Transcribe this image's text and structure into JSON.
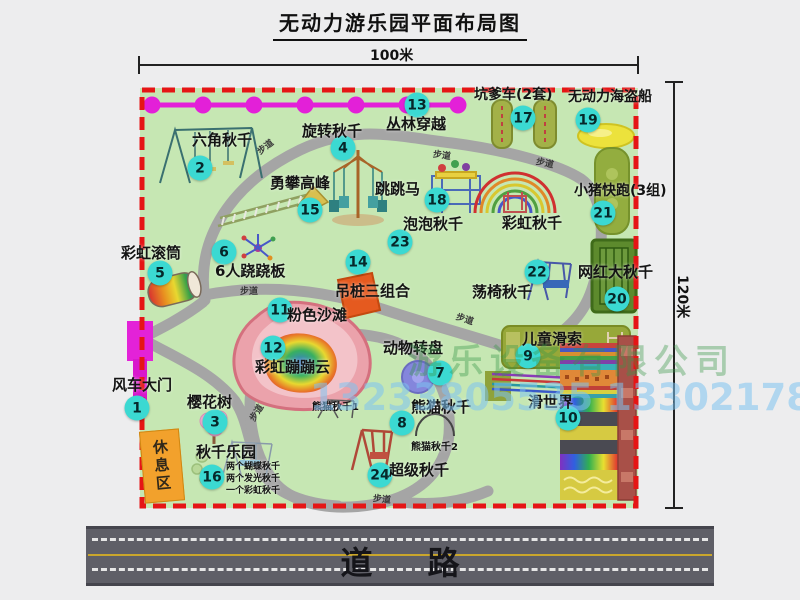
{
  "title": "无动力游乐园平面布局图",
  "dim": {
    "w": "100米",
    "h": "120米"
  },
  "road_label": "道路",
  "watermark": {
    "company": "游乐设备有限公司",
    "phone": "13233805535 13302178333"
  },
  "rest_area_label": "休息区",
  "colors": {
    "badge": "#3bd9d2",
    "border_dashed": "#e51515",
    "map_bg": "#c6e7b3",
    "walkway": "#a5a5a5",
    "chain": "#e320d8",
    "road": "#5f5f67",
    "rest_area": "#f2a12c"
  },
  "legend_items": [
    {
      "n": "1",
      "t": "风车大门",
      "bx": -3,
      "by": 320,
      "lx": -28,
      "ly": 290,
      "s": 15
    },
    {
      "n": "2",
      "t": "六角秋千",
      "bx": 60,
      "by": 80,
      "lx": 52,
      "ly": 45,
      "s": 15
    },
    {
      "n": "3",
      "t": "樱花树",
      "bx": 75,
      "by": 334,
      "lx": 47,
      "ly": 307,
      "s": 15
    },
    {
      "n": "4",
      "t": "旋转秋千",
      "bx": 203,
      "by": 60,
      "lx": 162,
      "ly": 36,
      "s": 15
    },
    {
      "n": "5",
      "t": "彩虹滚筒",
      "bx": 20,
      "by": 185,
      "lx": -19,
      "ly": 158,
      "s": 15
    },
    {
      "n": "6",
      "t": "6人跷跷板",
      "bx": 84,
      "by": 164,
      "lx": 75,
      "ly": 176,
      "s": 15
    },
    {
      "n": "7",
      "t": "动物转盘",
      "bx": 300,
      "by": 285,
      "lx": 243,
      "ly": 253,
      "s": 15
    },
    {
      "n": "8",
      "t": "熊猫秋千",
      "bx": 262,
      "by": 335,
      "lx": 271,
      "ly": 312,
      "s": 15
    },
    {
      "n": "9",
      "t": "儿童滑索",
      "bx": 388,
      "by": 268,
      "lx": 382,
      "ly": 244,
      "s": 15
    },
    {
      "n": "10",
      "t": "滑世界",
      "bx": 428,
      "by": 330,
      "lx": 388,
      "ly": 307,
      "s": 15
    },
    {
      "n": "11",
      "t": "粉色沙滩",
      "bx": 140,
      "by": 222,
      "lx": 147,
      "ly": 220,
      "s": 15
    },
    {
      "n": "12",
      "t": "彩虹蹦蹦云",
      "bx": 133,
      "by": 260,
      "lx": 115,
      "ly": 272,
      "s": 15
    },
    {
      "n": "13",
      "t": "丛林穿越",
      "bx": 277,
      "by": 17,
      "lx": 246,
      "ly": 29,
      "s": 15
    },
    {
      "n": "14",
      "t": "吊桩三组合",
      "bx": 218,
      "by": 174,
      "lx": 195,
      "ly": 196,
      "s": 15
    },
    {
      "n": "15",
      "t": "勇攀高峰",
      "bx": 170,
      "by": 122,
      "lx": 130,
      "ly": 88,
      "s": 15
    },
    {
      "n": "16",
      "t": "秋千乐园",
      "bx": 72,
      "by": 389,
      "lx": 56,
      "ly": 357,
      "s": 15
    },
    {
      "n": "17",
      "t": "坑爹车(2套)",
      "bx": 383,
      "by": 30,
      "lx": 334,
      "ly": 0,
      "s": 14
    },
    {
      "n": "18",
      "t": "跳跳马",
      "bx": 297,
      "by": 112,
      "lx": 235,
      "ly": 94,
      "s": 15
    },
    {
      "n": "19",
      "t": "无动力海盗船",
      "bx": 448,
      "by": 32,
      "lx": 428,
      "ly": 2,
      "s": 14
    },
    {
      "n": "20",
      "t": "网红大秋千",
      "bx": 477,
      "by": 211,
      "lx": 438,
      "ly": 177,
      "s": 15
    },
    {
      "n": "21",
      "t": "小猪快跑(3组)",
      "bx": 463,
      "by": 125,
      "lx": 434,
      "ly": 96,
      "s": 14
    },
    {
      "n": "22",
      "t": "荡椅秋千",
      "bx": 397,
      "by": 184,
      "lx": 332,
      "ly": 197,
      "s": 15
    },
    {
      "n": "23",
      "t": "泡泡秋千",
      "bx": 260,
      "by": 154,
      "lx": 263,
      "ly": 129,
      "s": 15
    },
    {
      "n": "24",
      "t": "超级秋千",
      "bx": 240,
      "by": 387,
      "lx": 249,
      "ly": 375,
      "s": 15
    }
  ],
  "extra_labels": [
    {
      "t": "彩虹秋千",
      "x": 362,
      "y": 128,
      "s": 15
    },
    {
      "t": "熊猫秋千1",
      "x": 172,
      "y": 315,
      "s": 10
    },
    {
      "t": "熊猫秋千2",
      "x": 271,
      "y": 355,
      "s": 10
    },
    {
      "t": "两个蝴蝶秋千",
      "x": 86,
      "y": 375,
      "s": 9
    },
    {
      "t": "两个发光秋千",
      "x": 86,
      "y": 387,
      "s": 9
    },
    {
      "t": "一个彩虹秋千",
      "x": 86,
      "y": 399,
      "s": 9
    }
  ],
  "path_labels": [
    {
      "t": "步道",
      "x": 116,
      "y": 52,
      "r": -38
    },
    {
      "t": "步道",
      "x": 293,
      "y": 60,
      "r": 8
    },
    {
      "t": "步道",
      "x": 396,
      "y": 68,
      "r": 12
    },
    {
      "t": "步道",
      "x": 100,
      "y": 196,
      "r": 0
    },
    {
      "t": "步道",
      "x": 316,
      "y": 224,
      "r": 18
    },
    {
      "t": "步道",
      "x": 107,
      "y": 318,
      "r": -58
    },
    {
      "t": "步道",
      "x": 233,
      "y": 404,
      "r": 6
    }
  ]
}
